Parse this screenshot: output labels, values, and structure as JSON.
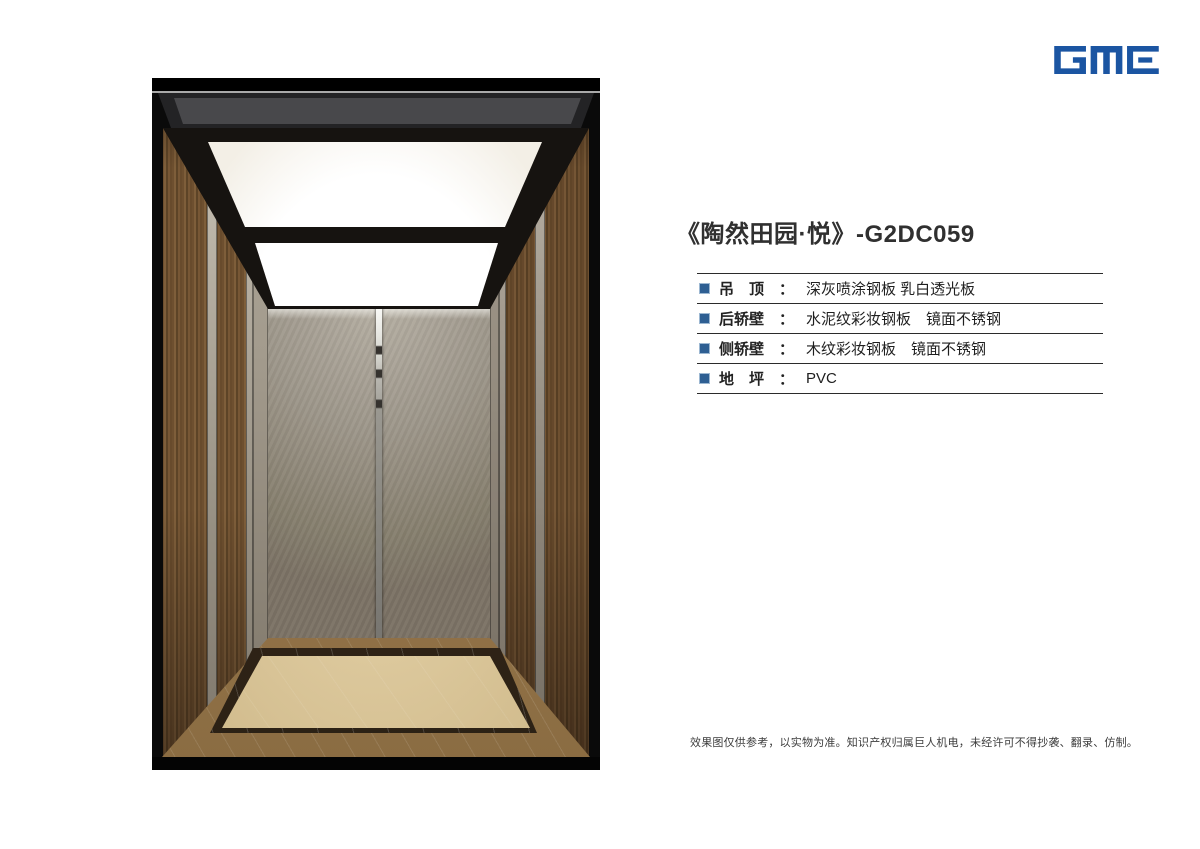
{
  "brand": {
    "logo_text": "GME",
    "logo_color": "#1b55a2"
  },
  "product": {
    "title": "《陶然田园·悦》-G2DC059"
  },
  "specs": {
    "colon": "：",
    "bullet_color": "#2e5f93",
    "rows": [
      {
        "label": "吊　顶",
        "value": "深灰喷涂钢板 乳白透光板"
      },
      {
        "label": "后轿壁",
        "value": "水泥纹彩妆钢板　镜面不锈钢"
      },
      {
        "label": "侧轿壁",
        "value": "木纹彩妆钢板　镜面不锈钢"
      },
      {
        "label": "地　坪",
        "value": "PVC"
      }
    ]
  },
  "footer": {
    "disclaimer": "效果图仅供参考，以实物为准。知识产权归属巨人机电，未经许可不得抄袭、翻录、仿制。"
  },
  "rendering": {
    "colors": {
      "ceiling_frame": "#161310",
      "light_panel": "#ffffff",
      "transom": "#48484b",
      "wood_wall": "#6d4f2f",
      "cement_wall": "#9d968a",
      "floor_band": "#8a6a40",
      "floor_border": "#2e2317",
      "floor_center": "#dcc89c"
    }
  }
}
